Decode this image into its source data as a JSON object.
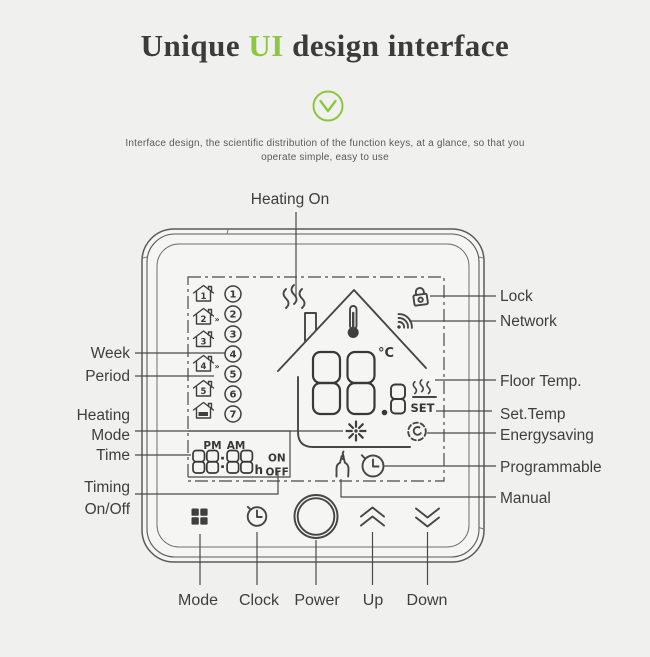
{
  "page": {
    "background": "#f0f0ee",
    "accent_green": "#8dc63f",
    "line_color": "#4a4a4a"
  },
  "header": {
    "title": {
      "part1": "Unique ",
      "accent": "UI",
      "part2": " design interface"
    },
    "check_icon": "chevron-down-circle-icon",
    "description_line1": "Interface design, the scientific distribution of the function keys, at a glance, so that you",
    "description_line2": "operate simple, easy to use"
  },
  "device": {
    "display": {
      "week_numbers": [
        "1",
        "2",
        "3",
        "4",
        "5",
        "6",
        "7"
      ],
      "periods": [
        {
          "num": "1",
          "mark": ""
        },
        {
          "num": "2",
          "mark": "»"
        },
        {
          "num": "3",
          "mark": ""
        },
        {
          "num": "4",
          "mark": "»"
        },
        {
          "num": "5",
          "mark": ""
        },
        {
          "num": "",
          "mark": "",
          "sleep": true
        }
      ],
      "pm_label": "PM",
      "am_label": "AM",
      "time_value": "88:88",
      "time_unit": "h",
      "on_label": "ON",
      "off_label": "OFF",
      "temp_value": "88.8",
      "temp_unit": "°C",
      "set_label": "SET"
    },
    "buttons": [
      "mode-grid",
      "clock",
      "power",
      "up",
      "down"
    ]
  },
  "callouts": {
    "heating_on": "Heating On",
    "left": [
      {
        "id": "week",
        "label": "Week"
      },
      {
        "id": "period",
        "label": "Period"
      },
      {
        "id": "heating-mode",
        "label": "Heating Mode"
      },
      {
        "id": "time",
        "label": "Time"
      },
      {
        "id": "timing-onoff",
        "label": "Timing On/Off"
      }
    ],
    "right": [
      {
        "id": "lock",
        "label": "Lock"
      },
      {
        "id": "network",
        "label": "Network"
      },
      {
        "id": "floor-temp",
        "label": "Floor Temp."
      },
      {
        "id": "set-temp",
        "label": "Set.Temp"
      },
      {
        "id": "energysaving",
        "label": "Energysaving"
      },
      {
        "id": "programmable",
        "label": "Programmable"
      },
      {
        "id": "manual",
        "label": "Manual"
      }
    ],
    "bottom": [
      {
        "id": "mode",
        "label": "Mode"
      },
      {
        "id": "clock",
        "label": "Clock"
      },
      {
        "id": "power",
        "label": "Power"
      },
      {
        "id": "up",
        "label": "Up"
      },
      {
        "id": "down",
        "label": "Down"
      }
    ]
  }
}
